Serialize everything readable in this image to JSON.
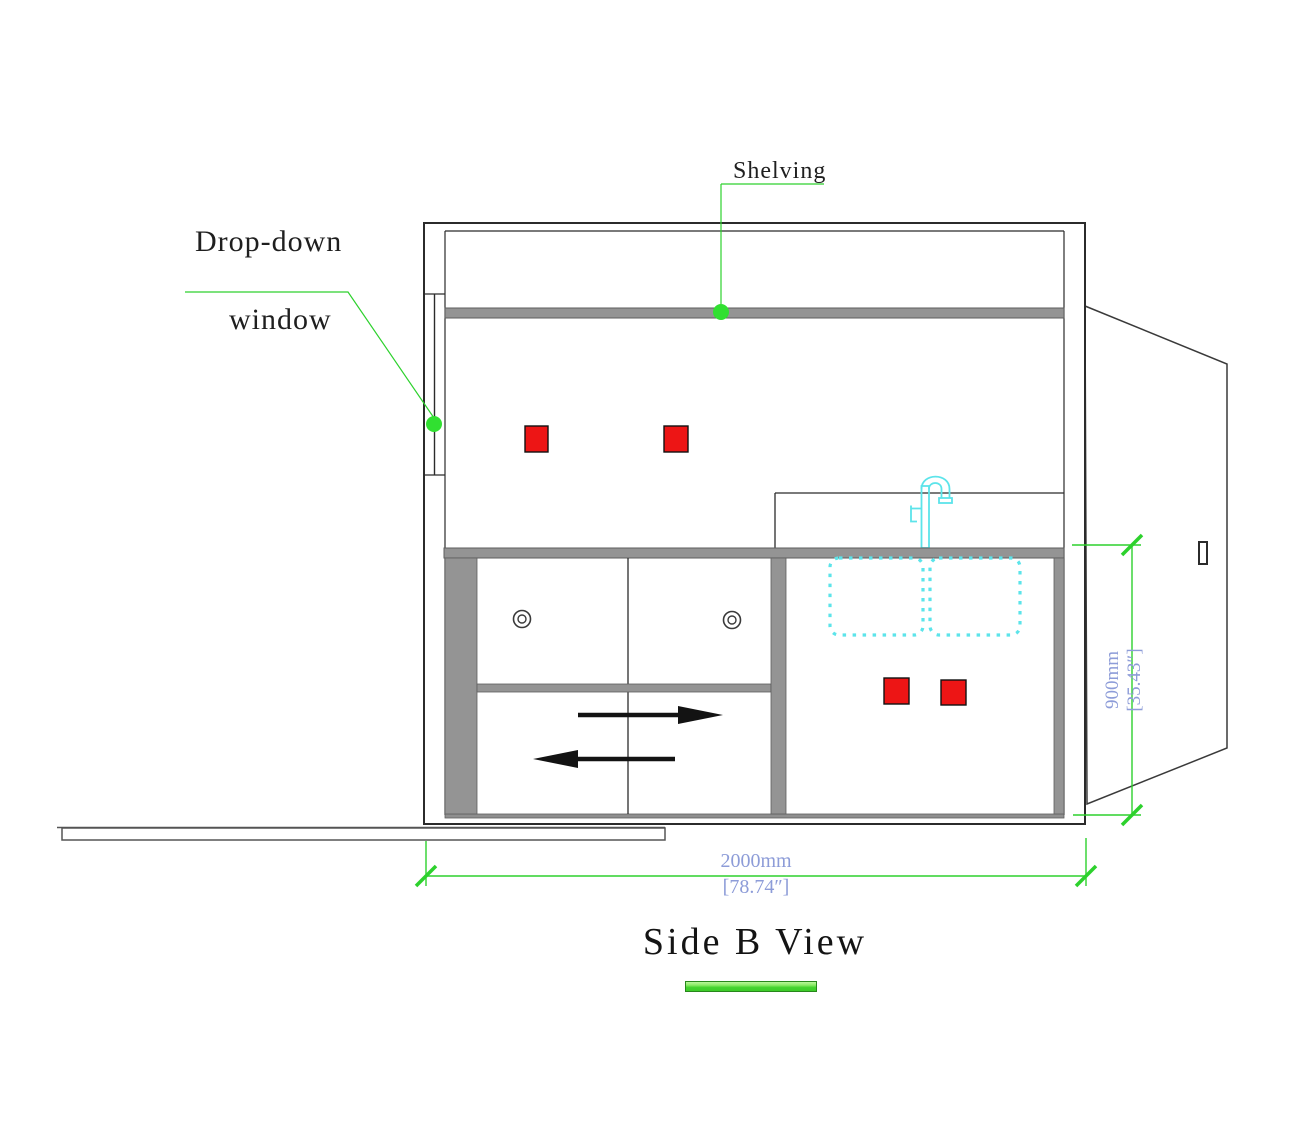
{
  "drawing": {
    "annotations": {
      "shelving": "Shelving",
      "drop_down_window": [
        "Drop-down",
        "window"
      ]
    },
    "dimensions": {
      "width_metric": "2000mm",
      "width_imperial": "[78.74″]",
      "height_metric": "900mm",
      "height_imperial": "[35.43″]"
    },
    "title": "Side B View",
    "colors": {
      "annotation_green": "#2dd12d",
      "dimension_text_blue": "#8d9cd8",
      "outlet_red": "#ed1515",
      "sink_cyan": "#5ce4ea",
      "panel_gray": "#949494",
      "line_dark": "#2b2b2b"
    }
  }
}
